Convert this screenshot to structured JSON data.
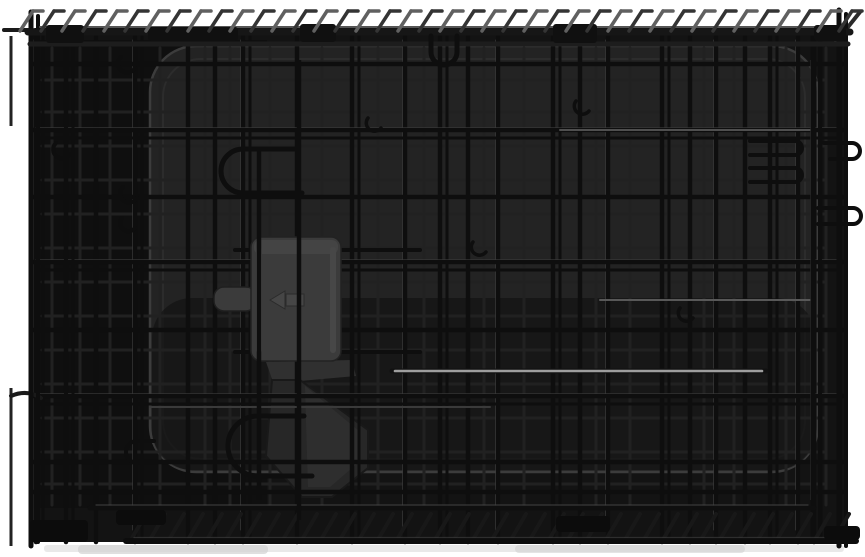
{
  "meta": {
    "description": "Product photograph of a black folding metal wire dog crate, collapsed flat, with a black plastic floor pan behind the mesh, a grey slide-bolt latch with release tab, folded carry handle, looped top-panel wires along the top edge and a wire base grid, on a plain white studio background",
    "image_type": "product-photo"
  },
  "palette": {
    "background": "#ffffff",
    "interior": "#131313",
    "interior_vignette": "#0d0d0d",
    "tray": "#232323",
    "tray_edge": "#3c3c3c",
    "tray_inner": "#2c2c2c",
    "wire": "#0e0e0e",
    "wire_back": "#212121",
    "wire_highlight": "#9e9e9e",
    "wire_sheen": "#454545",
    "loop_light": "#606060",
    "loop_dark": "#343434",
    "plastic_latch": "#3b3b3b",
    "plastic_latch_top": "#444444",
    "plastic_latch_ridge": "#474747",
    "plastic_emboss": "#464646",
    "plastic_handle": "#272727",
    "plastic_handle_face": "#303030",
    "shadow": "#e3e3e3",
    "shadow_dark": "#d2d2d2"
  },
  "parts": [
    "top-panel-loops",
    "top-frame-rails",
    "rail-clamps",
    "hanging-wire-hook",
    "wire-mesh-front-panel",
    "wire-mesh-back-panels",
    "left-frame",
    "right-frame",
    "door-u-hooks",
    "side-latch-hooks",
    "wire-clips",
    "slide-bolt-latch",
    "latch-release-tab",
    "latch-emboss-arrow",
    "folded-carry-handle",
    "plastic-floor-pan",
    "base-grid",
    "corner-feet",
    "floor-shadow"
  ],
  "geometry": {
    "canvas": {
      "w": 865,
      "h": 557
    },
    "interior": {
      "x": 30,
      "y": 28,
      "w": 814,
      "h": 514
    },
    "vignette": {
      "x": 32,
      "y": 40,
      "w": 235,
      "h": 468
    },
    "tray": {
      "x": 150,
      "y": 46,
      "w": 668,
      "h": 426,
      "r": 46
    },
    "tray_inner": {
      "x": 163,
      "y": 59,
      "w": 642,
      "h": 400,
      "r": 38
    },
    "grid": {
      "top": 34,
      "bottom": 542,
      "left": 32,
      "right": 844
    },
    "back_span": {
      "top": 48,
      "bottom": 505,
      "left": 42,
      "right": 824
    },
    "front_verticals": [
      36,
      66,
      96,
      135,
      188,
      215,
      243,
      297,
      352,
      405,
      440,
      468,
      498,
      553,
      580,
      608,
      662,
      690,
      716,
      745,
      770,
      798,
      814,
      840
    ],
    "double_verticals": [
      36,
      135,
      243,
      352,
      440,
      553,
      662,
      770,
      814
    ],
    "front_horizontals": [
      64,
      130,
      197,
      262,
      330,
      396,
      462,
      492
    ],
    "double_horizontals": [
      130,
      262,
      396
    ],
    "back_verticals": [
      52,
      80,
      110,
      160,
      205,
      230,
      270,
      322,
      378,
      424,
      484,
      524,
      596,
      630,
      704,
      734,
      786,
      826
    ],
    "back_horizontals": [
      80,
      112,
      146,
      180,
      214,
      248,
      282,
      316,
      350,
      384,
      418,
      452,
      484
    ],
    "frame_verticals": [
      {
        "x": 31,
        "y1": 12,
        "y2": 546,
        "w": 5
      },
      {
        "x": 38,
        "y1": 16,
        "y2": 542,
        "w": 4
      },
      {
        "x": 66,
        "y1": 30,
        "y2": 522,
        "w": 4
      },
      {
        "x": 73,
        "y1": 34,
        "y2": 520,
        "w": 3
      },
      {
        "x": 813,
        "y1": 36,
        "y2": 540,
        "w": 5
      },
      {
        "x": 820,
        "y1": 40,
        "y2": 536,
        "w": 4
      },
      {
        "x": 839,
        "y1": 10,
        "y2": 546,
        "w": 5
      },
      {
        "x": 846,
        "y1": 14,
        "y2": 546,
        "w": 4
      }
    ],
    "top_rails": [
      {
        "y": 32,
        "x1": 28,
        "x2": 850,
        "w": 7,
        "c": "#161616"
      },
      {
        "y": 44,
        "x1": 30,
        "x2": 848,
        "w": 5,
        "c": "#1d1d1d"
      },
      {
        "y": 27,
        "x1": 40,
        "x2": 840,
        "w": 2,
        "c": "#555555"
      }
    ],
    "top_loops": {
      "x_start": 20,
      "x_end": 848,
      "spacing": 21,
      "y_base": 31,
      "dx": 13,
      "dy": 20,
      "hook": 10
    },
    "clamps": [
      [
        46,
        25,
        38,
        18
      ],
      [
        148,
        27,
        90,
        14
      ],
      [
        300,
        24,
        36,
        18
      ],
      [
        553,
        24,
        44,
        19
      ],
      [
        814,
        25,
        32,
        16
      ]
    ],
    "base": {
      "rail1": {
        "y": 508,
        "x1": 90,
        "x2": 814
      },
      "rail2": {
        "y": 541,
        "x1": 126,
        "x2": 856
      },
      "hatch": {
        "x_start": 132,
        "x_end": 848,
        "spacing": 19,
        "dx": 14,
        "y_top": 514,
        "y_bot": 538
      }
    },
    "feet": [
      [
        30,
        520,
        58,
        22
      ],
      [
        116,
        510,
        50,
        15
      ],
      [
        556,
        516,
        54,
        16
      ],
      [
        824,
        526,
        36,
        14
      ]
    ],
    "highlight_wires": [
      {
        "x1": 392,
        "y1": 371,
        "x2": 766,
        "y2": 371,
        "w": 5,
        "c": "#111111"
      },
      {
        "x1": 395,
        "y1": 371,
        "x2": 762,
        "y2": 371,
        "w": 2.6,
        "c": "#9e9e9e"
      },
      {
        "x1": 600,
        "y1": 300,
        "x2": 810,
        "y2": 300,
        "w": 2,
        "c": "#585858"
      },
      {
        "x1": 560,
        "y1": 130,
        "x2": 812,
        "y2": 130,
        "w": 2,
        "c": "#4f4f4f"
      },
      {
        "x1": 150,
        "y1": 407,
        "x2": 490,
        "y2": 407,
        "w": 2,
        "c": "#3a3a3a"
      }
    ]
  }
}
